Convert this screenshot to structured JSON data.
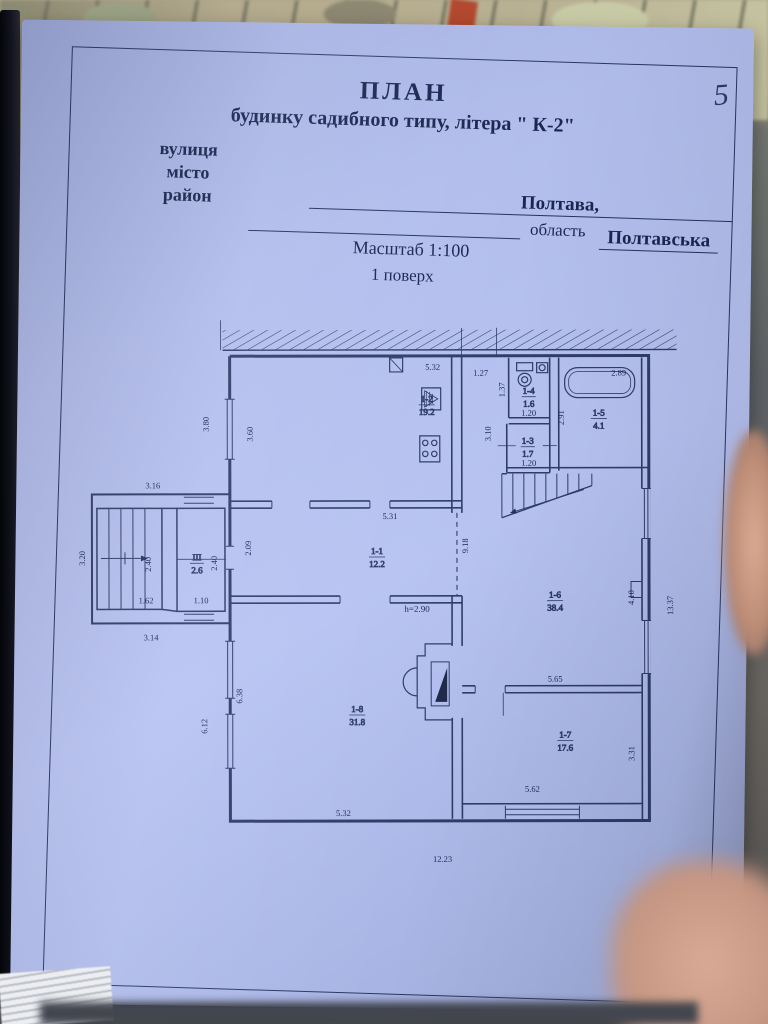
{
  "page": {
    "number": "5"
  },
  "header": {
    "title1": "ПЛАН",
    "title2": "будинку садибного типу, літера \" К-2\"",
    "label_street": "вулиця",
    "label_city": "місто",
    "label_district": "район",
    "city_value": "Полтава,",
    "oblast_label": "область",
    "oblast_value": "Полтавська",
    "scale": "Масштаб 1:100",
    "floor": "1 поверх"
  },
  "plan": {
    "rooms": [
      {
        "id": "1-2",
        "area": "19.2"
      },
      {
        "id": "1-4",
        "area": "1.6"
      },
      {
        "id": "1-3",
        "area": "1.7"
      },
      {
        "id": "1-5",
        "area": "4.1"
      },
      {
        "id": "1-1",
        "area": "12.2"
      },
      {
        "id": "1-6",
        "area": "38.4"
      },
      {
        "id": "1-8",
        "area": "31.8"
      },
      {
        "id": "1-7",
        "area": "17.6"
      },
      {
        "id": "III",
        "area": "2.6"
      }
    ],
    "height_note": "h=2.90",
    "dims": {
      "k_top": "5.32",
      "k_left_in": "3.60",
      "k_left_out": "3.80",
      "corridor": "1.27",
      "wc_left": "1.37",
      "wc_bot": "1.20",
      "r13_side": "3.10",
      "r13_bot": "1.20",
      "bath_top": "2.89",
      "bath_left": "2.91",
      "annex_top": "3.16",
      "annex_left": "3.20",
      "annex_bot": "3.14",
      "stairs_w": "1.62",
      "stairs_v": "2.40",
      "vest_v": "2.40",
      "vest_w": "1.10",
      "r11_top": "5.31",
      "r11_left": "2.09",
      "mid_len": "9.18",
      "r18_left_out": "6.12",
      "r18_left_in": "6.38",
      "r18_bot": "5.32",
      "r16_bot": "5.65",
      "r16_right": "4.10",
      "right_out": "13.37",
      "r17_bot": "5.62",
      "r17_right": "3.31",
      "total_bot": "12.23"
    }
  }
}
